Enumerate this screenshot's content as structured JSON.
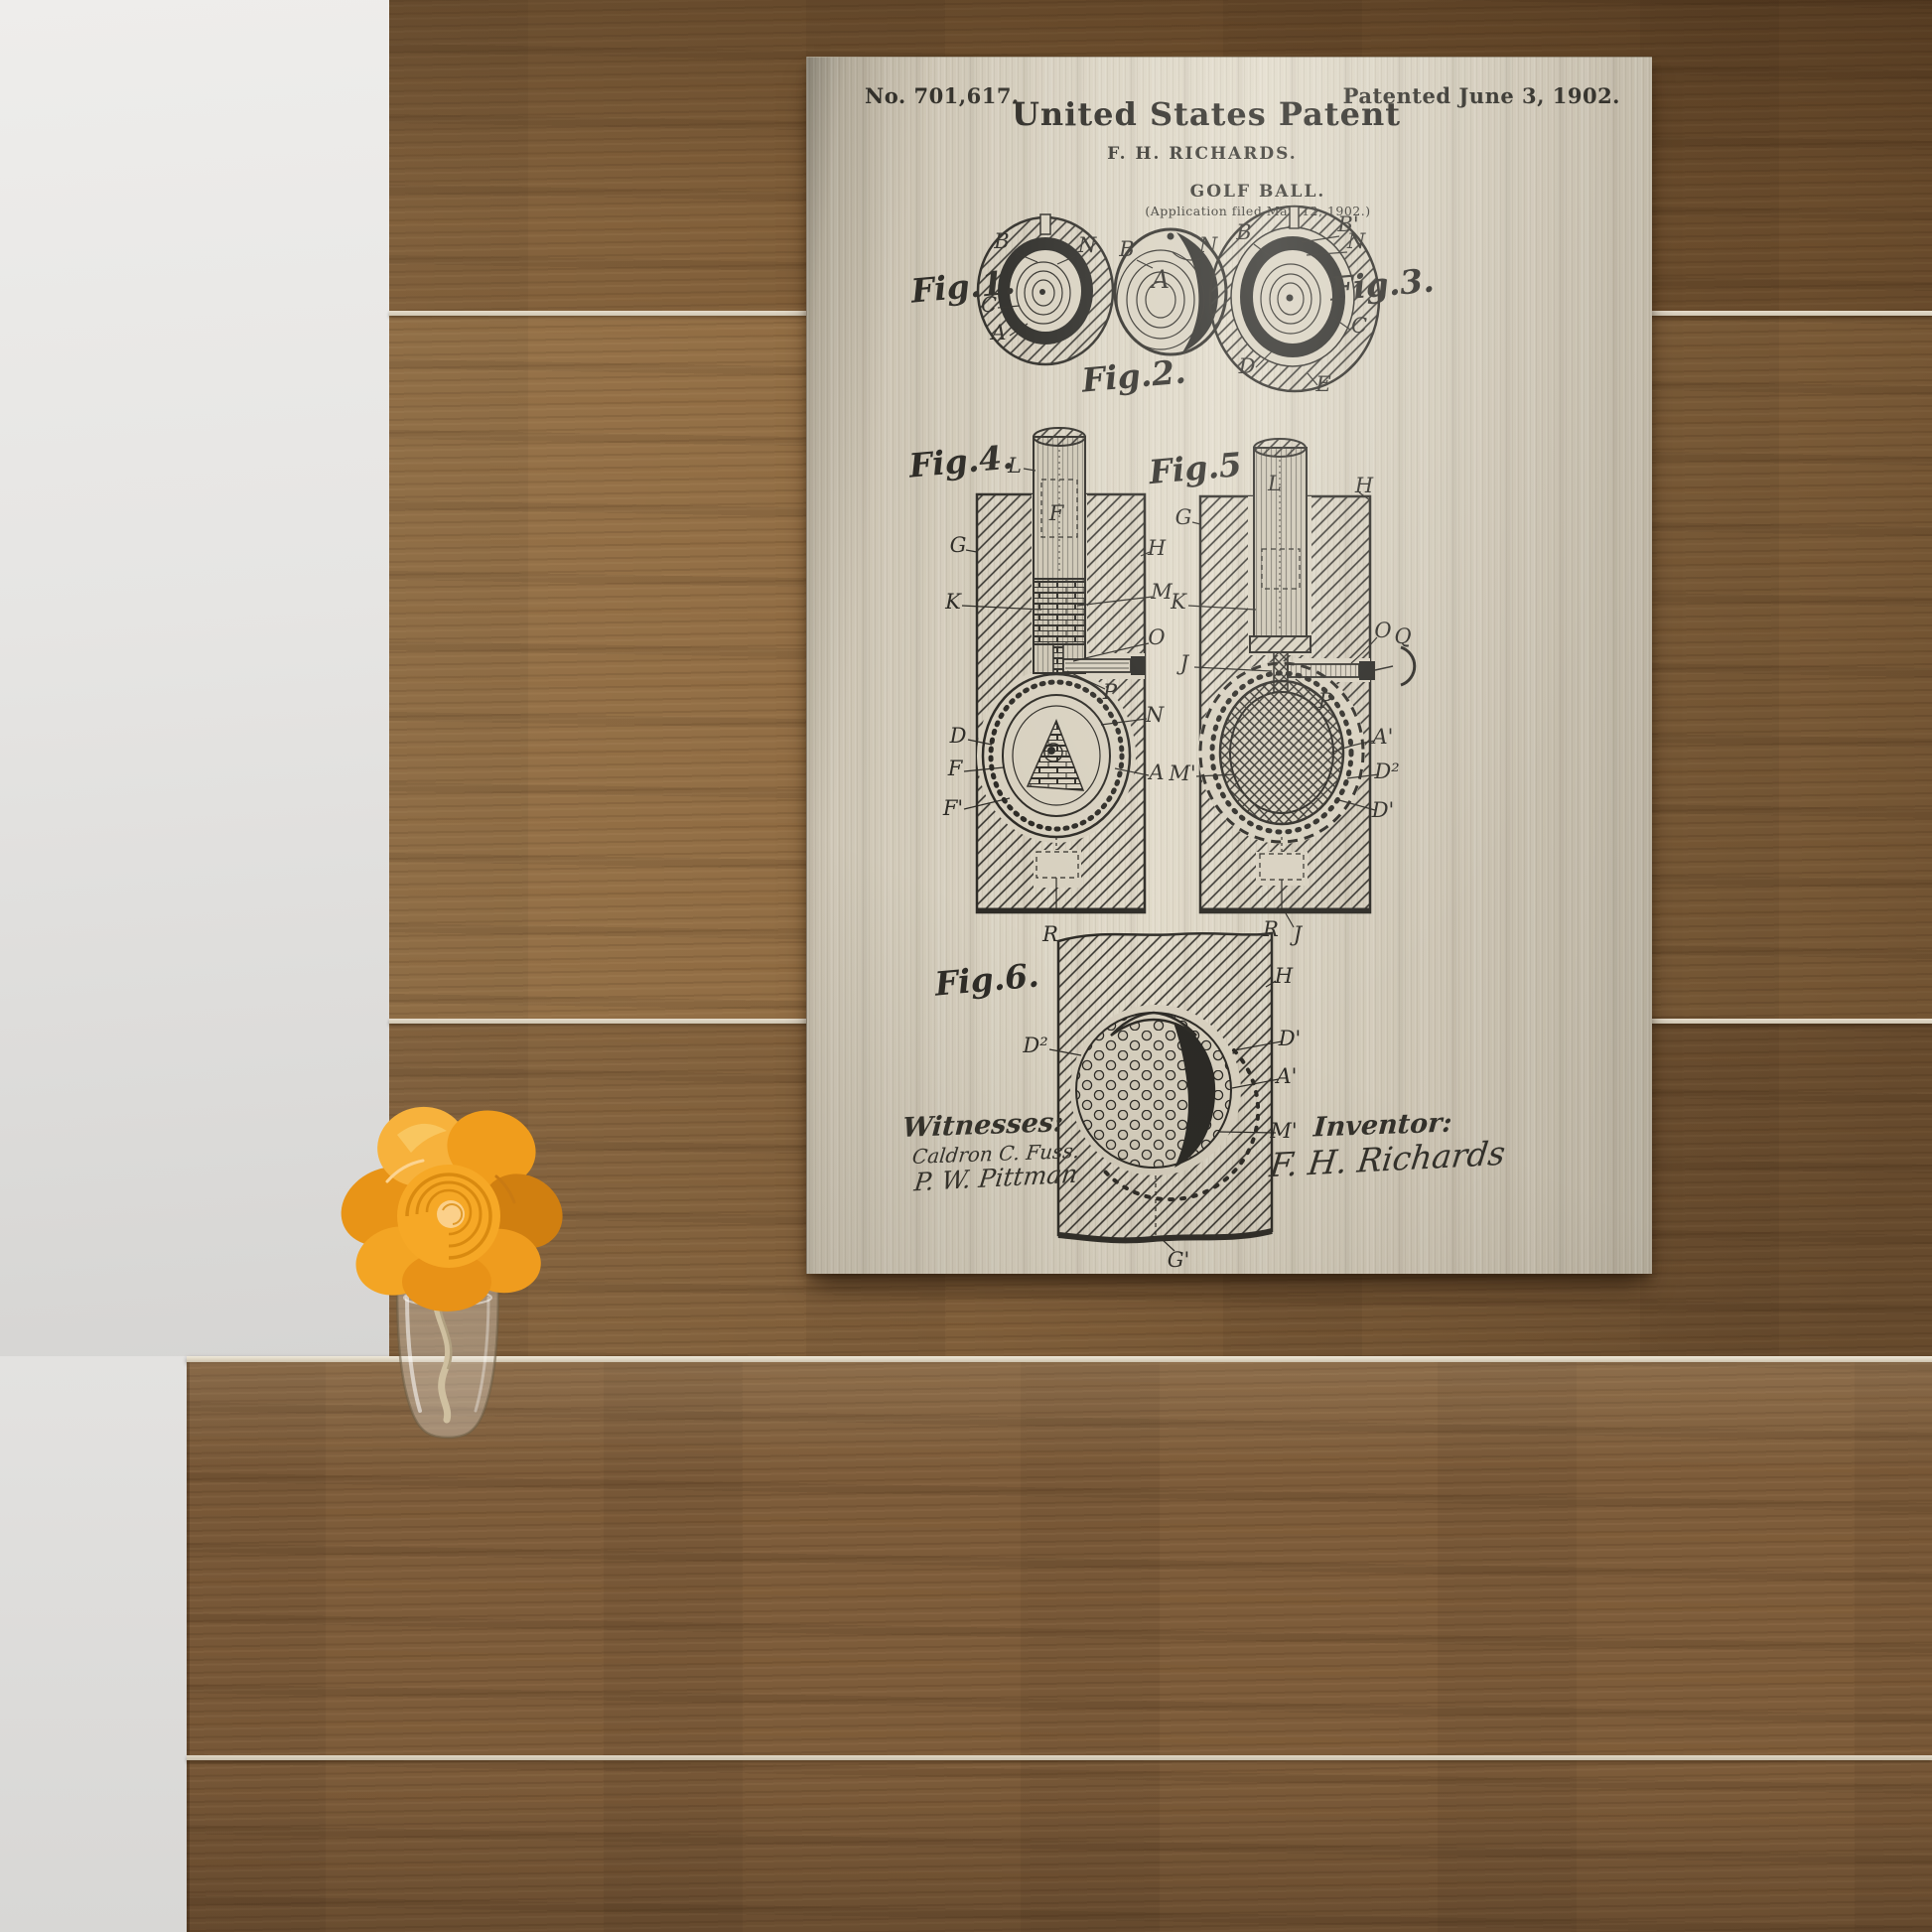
{
  "scene": {
    "setting": "Brushed-metal golf ball patent print hanging on a dark wood plank wall, orange flower in a glass vase on a wooden counter, white wall at left",
    "colors": {
      "wall_white": "#e8e7e5",
      "wood_light": "#9c7344",
      "wood_mid": "#8a6742",
      "wood_dark": "#5f4628",
      "counter_wood": "#7d5c3a",
      "plank_seam": "#ddd5c5",
      "canvas_light": "#ded7c6",
      "canvas_mid": "#c9c1b0",
      "canvas_edge": "#8e887a",
      "ink": "#2e2c27",
      "flower_orange": "#f5a125",
      "flower_deep": "#dd8613",
      "flower_light": "#fbd08a"
    }
  },
  "patent": {
    "patent_number_label": "No. 701,617.",
    "patented_date": "Patented June 3, 1902.",
    "title": "United States Patent",
    "inventor_name": "F. H. RICHARDS.",
    "subject": "GOLF BALL.",
    "application_line": "(Application filed Mar. 12, 1902.)",
    "fig1": {
      "caption": "Fig.1.",
      "labels": [
        "B",
        "N",
        "C",
        "A"
      ]
    },
    "fig2": {
      "caption": "Fig.2.",
      "labels": [
        "B",
        "N",
        "A"
      ]
    },
    "fig3": {
      "caption": "Fig.3.",
      "labels": [
        "B",
        "B'",
        "N",
        "C",
        "D",
        "E"
      ]
    },
    "fig4": {
      "caption": "Fig.4.",
      "labels": [
        "L",
        "F",
        "G",
        "H",
        "K",
        "M",
        "O",
        "P",
        "N",
        "D",
        "F",
        "A",
        "F'",
        "R"
      ]
    },
    "fig5": {
      "caption": "Fig.5",
      "labels": [
        "L",
        "H",
        "G",
        "K",
        "O",
        "J",
        "Q",
        "P",
        "A'",
        "M'",
        "D²",
        "D'",
        "R",
        "J"
      ]
    },
    "fig6": {
      "caption": "Fig.6.",
      "labels": [
        "H",
        "D²",
        "D'",
        "A'",
        "M'",
        "G'"
      ]
    },
    "witnesses_heading": "Witnesses:",
    "witness_1": "Caldron C. Fuss.",
    "witness_2": "P. W. Pittman",
    "inventor_heading": "Inventor:",
    "inventor_signature": "F. H. Richards"
  }
}
